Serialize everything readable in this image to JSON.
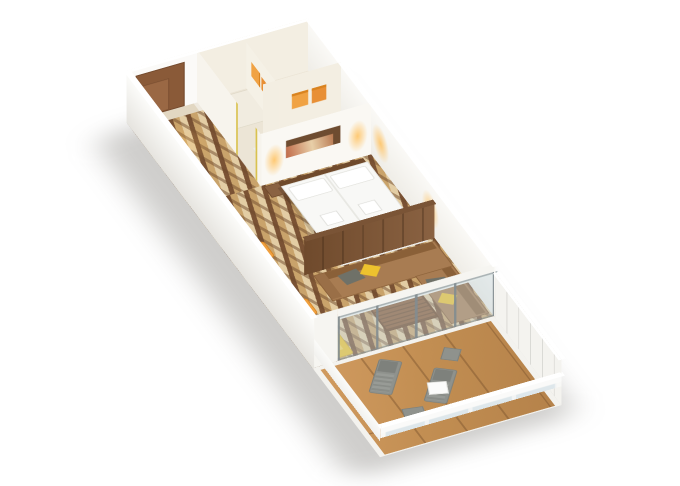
{
  "scene": {
    "description": "3D isometric cutaway rendering of a cruise-ship veranda suite stateroom floor plan on a white background",
    "background": "#ffffff",
    "view": "dollhouse-isometric, long narrow cabin running from upper-left (entrance and bathroom) to lower-right (private balcony)"
  },
  "colors": {
    "carpet_dark": "#7a5234",
    "carpet_mid": "#c9a36b",
    "carpet_light": "#e3cda4",
    "wood_dark": "#6f4a2c",
    "wood_mid": "#8a6242",
    "sofa": "#a87c52",
    "sofa_dark": "#8a6038",
    "deck": "#c28e52",
    "accent_orange": "#efa040",
    "accent_yellow": "#edc22e",
    "gray_furniture": "#8f928d",
    "bath_floor": "#ece5d6",
    "wall_white": "#fbfaf8",
    "wall_cream": "#f3eee2",
    "glass": "#c3d5df",
    "bed_white": "#f8f8f6",
    "glow": "#ffc15e",
    "door_wood": "#8a5a38"
  },
  "rooms": [
    {
      "name": "entry-hall",
      "floor": "zebra-stripe-carpet",
      "features": [
        "entrance-door",
        "doormat"
      ]
    },
    {
      "name": "bathroom",
      "floor": "stone-tile",
      "features": [
        "shower-stall",
        "towel-partition",
        "orange-towels",
        "toilet",
        "bathtub-vanity"
      ]
    },
    {
      "name": "bedroom",
      "floor": "zebra-stripe-carpet",
      "features": [
        "double-bed",
        "white-pillows",
        "brown-bed-runner",
        "folded-towels",
        "wood-headboard",
        "nightstand",
        "wall-art",
        "warm-wall-lamps",
        "vanity-desk",
        "orange-chair"
      ]
    },
    {
      "name": "living-room",
      "floor": "zebra-stripe-carpet",
      "features": [
        "wood-divider-wall",
        "l-shaped-sofa",
        "gray-pillows",
        "yellow-pillows",
        "slatted-coffee-table",
        "writing-desk",
        "orange-chair",
        "yellow-armchair",
        "yellow-ottoman"
      ]
    },
    {
      "name": "balcony",
      "floor": "teak-deck",
      "features": [
        "sliding-glass-doors",
        "lounge-chair",
        "lounge-chair",
        "white-side-table",
        "gray-ottoman",
        "gray-ottoman",
        "glass-front-railing",
        "ribbed-side-wall"
      ]
    }
  ]
}
